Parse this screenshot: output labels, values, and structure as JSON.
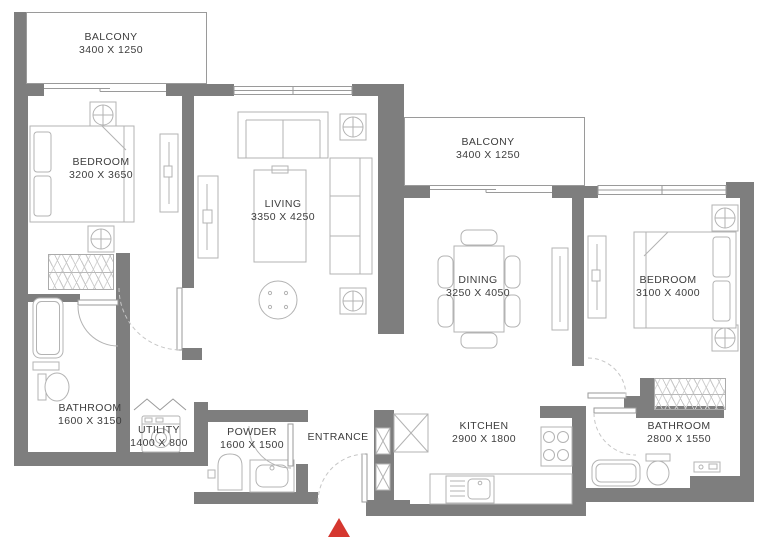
{
  "rooms": [
    {
      "name": "BALCONY",
      "dims": "3400 X 1250"
    },
    {
      "name": "BEDROOM",
      "dims": "3200 X 3650"
    },
    {
      "name": "LIVING",
      "dims": "3350 X 4250"
    },
    {
      "name": "BALCONY",
      "dims": "3400 X 1250"
    },
    {
      "name": "DINING",
      "dims": "3250 X 4050"
    },
    {
      "name": "BEDROOM",
      "dims": "3100 X 4000"
    },
    {
      "name": "BATHROOM",
      "dims": "1600 X 3150"
    },
    {
      "name": "UTILITY",
      "dims": "1400 X 800"
    },
    {
      "name": "POWDER",
      "dims": "1600 X 1500"
    },
    {
      "name": "ENTRANCE",
      "dims": ""
    },
    {
      "name": "KITCHEN",
      "dims": "2900 X 1800"
    },
    {
      "name": "BATHROOM",
      "dims": "2800 X 1550"
    }
  ],
  "icons": {
    "entrance_marker": "up-triangle",
    "column_symbol": "circle-cross-in-square",
    "shaft_symbol": "x-in-square"
  },
  "colors": {
    "wall": "#7e7e7e",
    "furniture_line": "#b3b3b3",
    "window_line": "#9a9a9a",
    "text": "#3d3d3d",
    "entrance_marker": "#d5372f"
  }
}
